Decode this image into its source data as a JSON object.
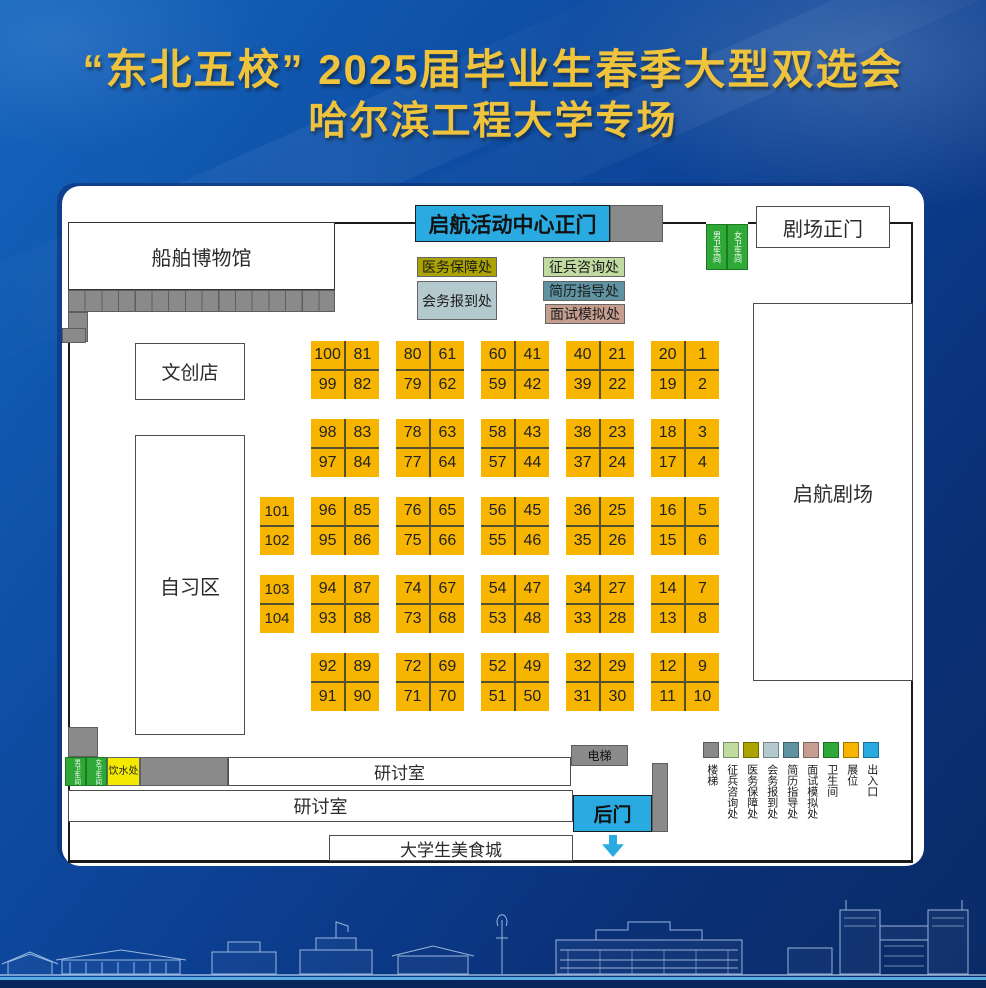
{
  "header": {
    "title_line1": "“东北五校” 2025届毕业生春季大型双选会",
    "title_line2": "哈尔滨工程大学专场"
  },
  "rooms": {
    "ship_museum": "船舶博物馆",
    "theater_entrance": "剧场正门",
    "culture_store": "文创店",
    "study_area": "自习区",
    "qihang_theater": "启航剧场",
    "seminar_room": "研讨室",
    "food_court": "大学生美食城"
  },
  "entrances": {
    "main": "启航活动中心正门",
    "back": "后门"
  },
  "facilities": [
    {
      "key": "medical",
      "label": "医务保障处",
      "color": "#ABA300"
    },
    {
      "key": "checkin",
      "label": "会务报到处",
      "color": "#B3C9CE"
    },
    {
      "key": "conscription",
      "label": "征兵咨询处",
      "color": "#C0DA9F"
    },
    {
      "key": "resume",
      "label": "简历指导处",
      "color": "#5F93A2"
    },
    {
      "key": "interview",
      "label": "面试模拟处",
      "color": "#C69E90"
    }
  ],
  "restrooms": {
    "male": "男卫生间",
    "female": "女卫生间"
  },
  "water": {
    "label": "饮水处"
  },
  "elevator": {
    "label": "电梯"
  },
  "legend": {
    "items": [
      {
        "label": "楼梯",
        "color": "#8A8A8A"
      },
      {
        "label": "征兵咨询处",
        "color": "#C0DA9F"
      },
      {
        "label": "医务保障处",
        "color": "#ABA300"
      },
      {
        "label": "会务报到处",
        "color": "#B3C9CE"
      },
      {
        "label": "简历指导处",
        "color": "#5F93A2"
      },
      {
        "label": "面试模拟处",
        "color": "#C69E90"
      },
      {
        "label": "卫生间",
        "color": "#2FA838"
      },
      {
        "label": "展位",
        "color": "#F7B500"
      },
      {
        "label": "出入口",
        "color": "#29ABE2"
      }
    ]
  },
  "booths": {
    "color": "#F7B500",
    "rows": [
      {
        "blocks": [
          [
            100,
            81,
            99,
            82
          ],
          [
            80,
            61,
            79,
            62
          ],
          [
            60,
            41,
            59,
            42
          ],
          [
            40,
            21,
            39,
            22
          ],
          [
            20,
            1,
            19,
            2
          ]
        ]
      },
      {
        "blocks": [
          [
            98,
            83,
            97,
            84
          ],
          [
            78,
            63,
            77,
            64
          ],
          [
            58,
            43,
            57,
            44
          ],
          [
            38,
            23,
            37,
            24
          ],
          [
            18,
            3,
            17,
            4
          ]
        ]
      },
      {
        "blocks": [
          [
            96,
            85,
            95,
            86
          ],
          [
            76,
            65,
            75,
            66
          ],
          [
            56,
            45,
            55,
            46
          ],
          [
            36,
            25,
            35,
            26
          ],
          [
            16,
            5,
            15,
            6
          ]
        ]
      },
      {
        "blocks": [
          [
            94,
            87,
            93,
            88
          ],
          [
            74,
            67,
            73,
            68
          ],
          [
            54,
            47,
            53,
            48
          ],
          [
            34,
            27,
            33,
            28
          ],
          [
            14,
            7,
            13,
            8
          ]
        ]
      },
      {
        "blocks": [
          [
            92,
            89,
            91,
            90
          ],
          [
            72,
            69,
            71,
            70
          ],
          [
            52,
            49,
            51,
            50
          ],
          [
            32,
            29,
            31,
            30
          ],
          [
            12,
            9,
            11,
            10
          ]
        ]
      }
    ],
    "side_singles": [
      {
        "row": 3,
        "numbers": [
          101,
          102
        ]
      },
      {
        "row": 4,
        "numbers": [
          103,
          104
        ]
      }
    ]
  },
  "palette": {
    "background_blue": "#0C3E90",
    "title_gold": "#EFC33C",
    "panel_white": "#FFFFFF",
    "wall_black": "#1A1A1A",
    "booth_yellow": "#F7B500",
    "entrance_cyan": "#29ABE2",
    "stairs_gray": "#8A8A8A",
    "restroom_green": "#2FA838",
    "water_yellow": "#F4E900"
  }
}
